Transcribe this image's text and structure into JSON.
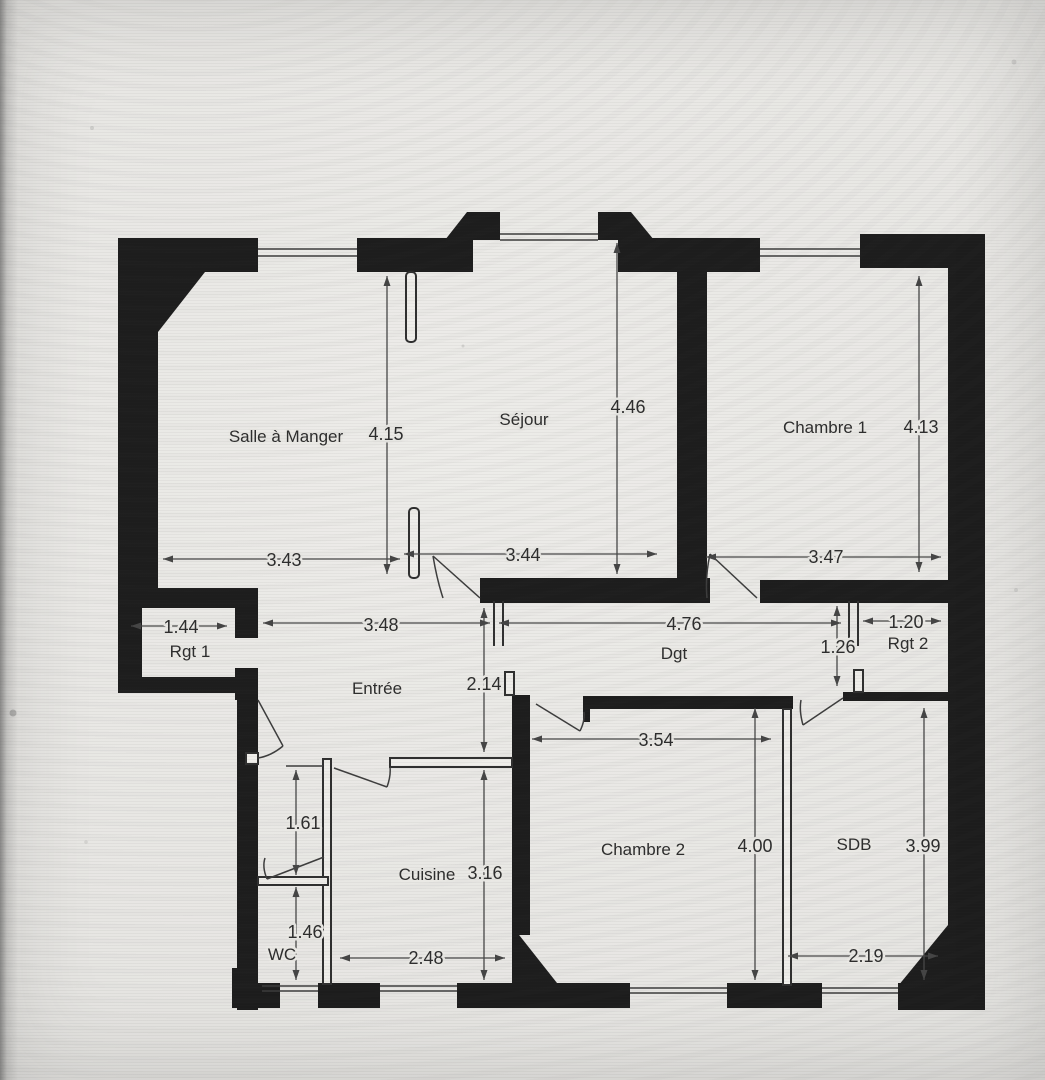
{
  "rooms": {
    "salle_a_manger": "Salle à Manger",
    "sejour": "Séjour",
    "chambre_1": "Chambre 1",
    "rgt_1": "Rgt 1",
    "entree": "Entrée",
    "dgt": "Dgt",
    "rgt_2": "Rgt 2",
    "wc": "WC",
    "cuisine": "Cuisine",
    "chambre_2": "Chambre 2",
    "sdb": "SDB"
  },
  "dimensions": {
    "salle_a_manger_width": "3.43",
    "salle_a_manger_height": "4.15",
    "sejour_width": "3.44",
    "sejour_height": "4.46",
    "chambre_1_width": "3.47",
    "chambre_1_height": "4.13",
    "rgt_1_width": "1.44",
    "entree_hall_width": "3.48",
    "degagement_width": "4.76",
    "rgt_2_width": "1.20",
    "rgt_2_height": "1.26",
    "entree_length": "2.14",
    "chambre_2_width": "3.54",
    "chambre_2_height": "4.00",
    "cuisine_width": "2.48",
    "cuisine_height": "3.16",
    "wc_upper_height": "1.61",
    "wc_lower_height": "1.46",
    "sdb_width": "2.19",
    "sdb_height": "3.99"
  },
  "colors": {
    "wall": "#1d1d1d",
    "paper": "#eae9e5",
    "ink": "#2d2d2d"
  }
}
